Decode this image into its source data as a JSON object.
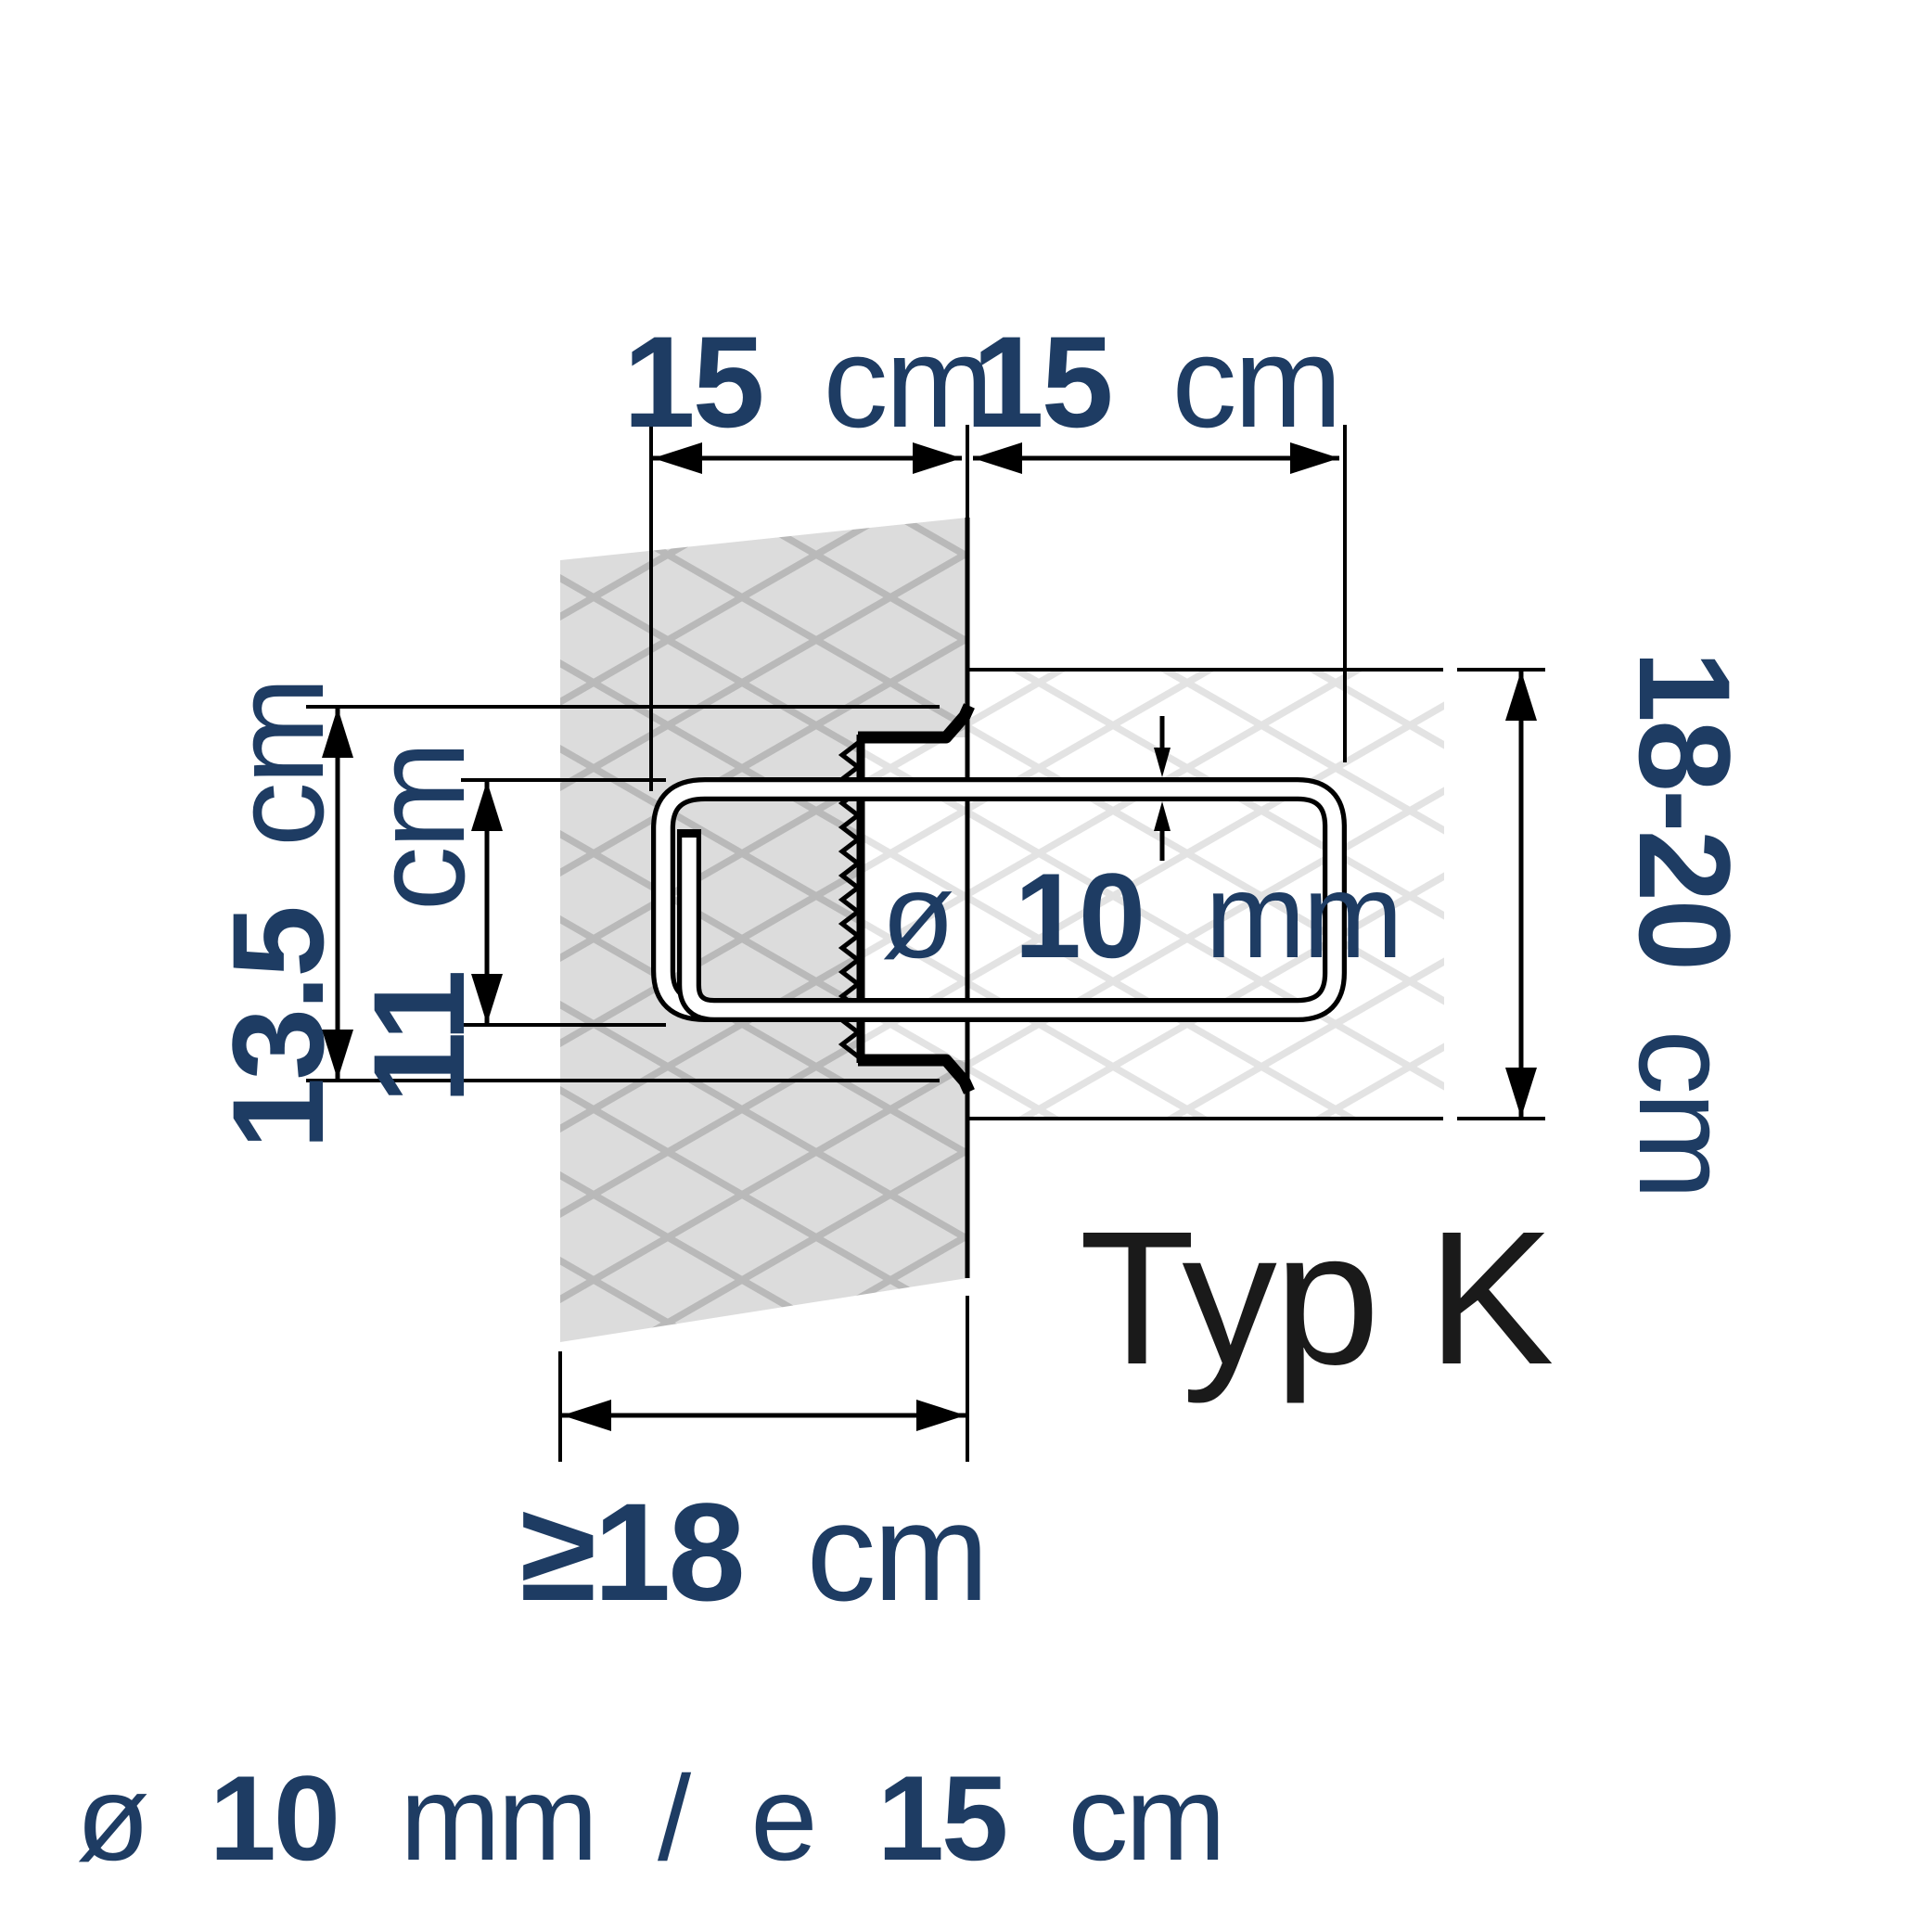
{
  "colors": {
    "label_navy": "#1e3c63",
    "line_black": "#000000",
    "type_black": "#1a1a1a",
    "wall_left_fill": "#dcdcdc",
    "wall_left_hatch": "#b9b9b9",
    "wall_right_fill": "#ffffff",
    "wall_right_hatch": "#e3e3e3",
    "rebar_fill": "#ffffff"
  },
  "dimensions": {
    "embedment_left": {
      "value": "15",
      "unit": "cm"
    },
    "embedment_right": {
      "value": "15",
      "unit": "cm"
    },
    "rail_height": {
      "value": "13.5",
      "unit": "cm"
    },
    "hook_spacing": {
      "value": "11",
      "unit": "cm"
    },
    "bar_diameter": {
      "symbol": "ø",
      "value": "10",
      "unit": "mm"
    },
    "course_height": {
      "value": "18-20",
      "unit": "cm"
    },
    "wall_thickness": {
      "value": "≥18",
      "unit": "cm"
    }
  },
  "labels": {
    "type": "Typ K",
    "footer": {
      "symbol": "ø",
      "diameter": "10",
      "diameter_unit": "mm",
      "separator": "/",
      "spacing_symbol": "e",
      "spacing": "15",
      "spacing_unit": "cm"
    }
  }
}
